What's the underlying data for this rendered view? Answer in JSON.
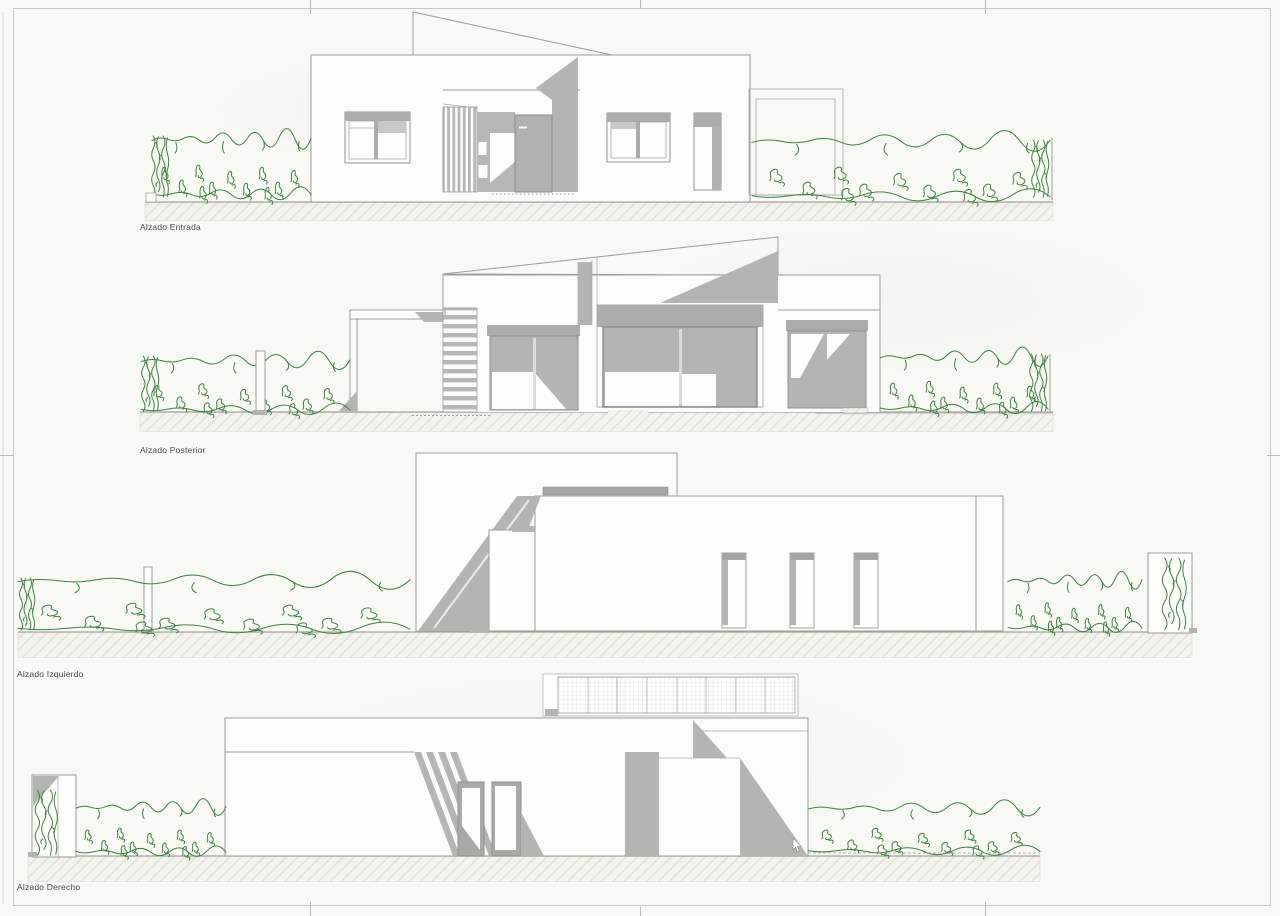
{
  "sheet": {
    "type": "architectural-elevations-drawing",
    "width_px": 1280,
    "height_px": 916
  },
  "elevations": [
    {
      "id": "entrada",
      "label": "Alzado Entrada"
    },
    {
      "id": "posterior",
      "label": "Alzado Posterior"
    },
    {
      "id": "izquierdo",
      "label": "Alzado Izquierdo"
    },
    {
      "id": "derecho",
      "label": "Alzado Derecho"
    }
  ],
  "palette": {
    "paper": "#f8f8f5",
    "building_face": "#fcfcfa",
    "line_gray": "#9b9b97",
    "frame_gray": "#8f8f8b",
    "shadow_gray": "#b4b4b0",
    "band_gray": "#acaca8",
    "hedge_green": "#3f8040",
    "ground_hatch": "#dddcd2",
    "label_text": "#4a4a46"
  }
}
